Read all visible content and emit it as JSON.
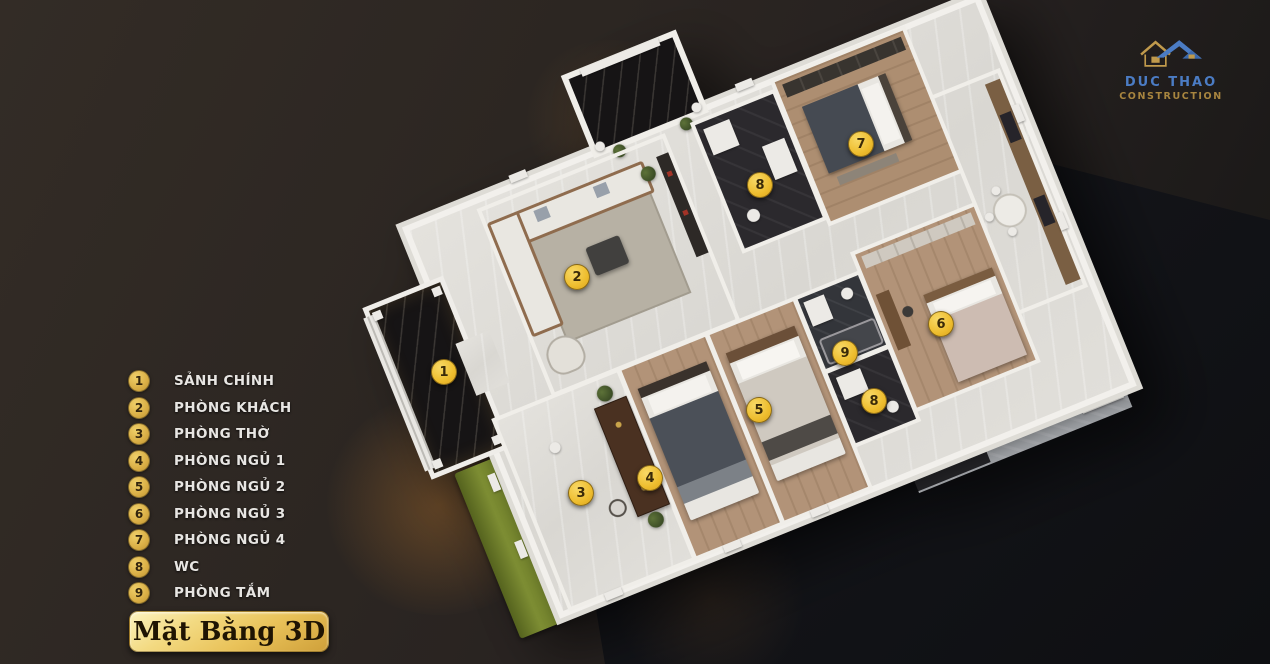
{
  "canvas": {
    "width": 1270,
    "height": 664
  },
  "colors": {
    "background_floor": "#121318",
    "background_wall": "#2b2521",
    "marker_gold": "#eebd2e",
    "legend_gold": "#d9ae45",
    "legend_text": "#e8e6e3",
    "title_text": "#1f1403",
    "logo_blue": "#4b7cc4",
    "logo_gold": "#a8853f"
  },
  "logo": {
    "name": "DUC THAO",
    "subtitle": "CONSTRUCTION",
    "icon": "house-roofs-icon"
  },
  "legend": {
    "items": [
      {
        "num": "1",
        "label": "SẢNH CHÍNH"
      },
      {
        "num": "2",
        "label": "PHÒNG KHÁCH"
      },
      {
        "num": "3",
        "label": "PHÒNG THỜ"
      },
      {
        "num": "4",
        "label": "PHÒNG NGỦ 1"
      },
      {
        "num": "5",
        "label": "PHÒNG NGỦ 2"
      },
      {
        "num": "6",
        "label": "PHÒNG NGỦ 3"
      },
      {
        "num": "7",
        "label": "PHÒNG NGỦ 4"
      },
      {
        "num": "8",
        "label": "WC"
      },
      {
        "num": "9",
        "label": "PHÒNG TẮM"
      }
    ]
  },
  "title": {
    "text": "Mặt Bằng 3D"
  },
  "plan": {
    "markers": [
      {
        "num": "1",
        "x": 444,
        "y": 372
      },
      {
        "num": "2",
        "x": 577,
        "y": 277
      },
      {
        "num": "3",
        "x": 581,
        "y": 493
      },
      {
        "num": "4",
        "x": 650,
        "y": 478
      },
      {
        "num": "5",
        "x": 759,
        "y": 410
      },
      {
        "num": "6",
        "x": 941,
        "y": 324
      },
      {
        "num": "7",
        "x": 861,
        "y": 144
      },
      {
        "num": "8",
        "x": 760,
        "y": 185
      },
      {
        "num": "9",
        "x": 845,
        "y": 353
      },
      {
        "num": "8",
        "x": 874,
        "y": 401
      }
    ]
  }
}
